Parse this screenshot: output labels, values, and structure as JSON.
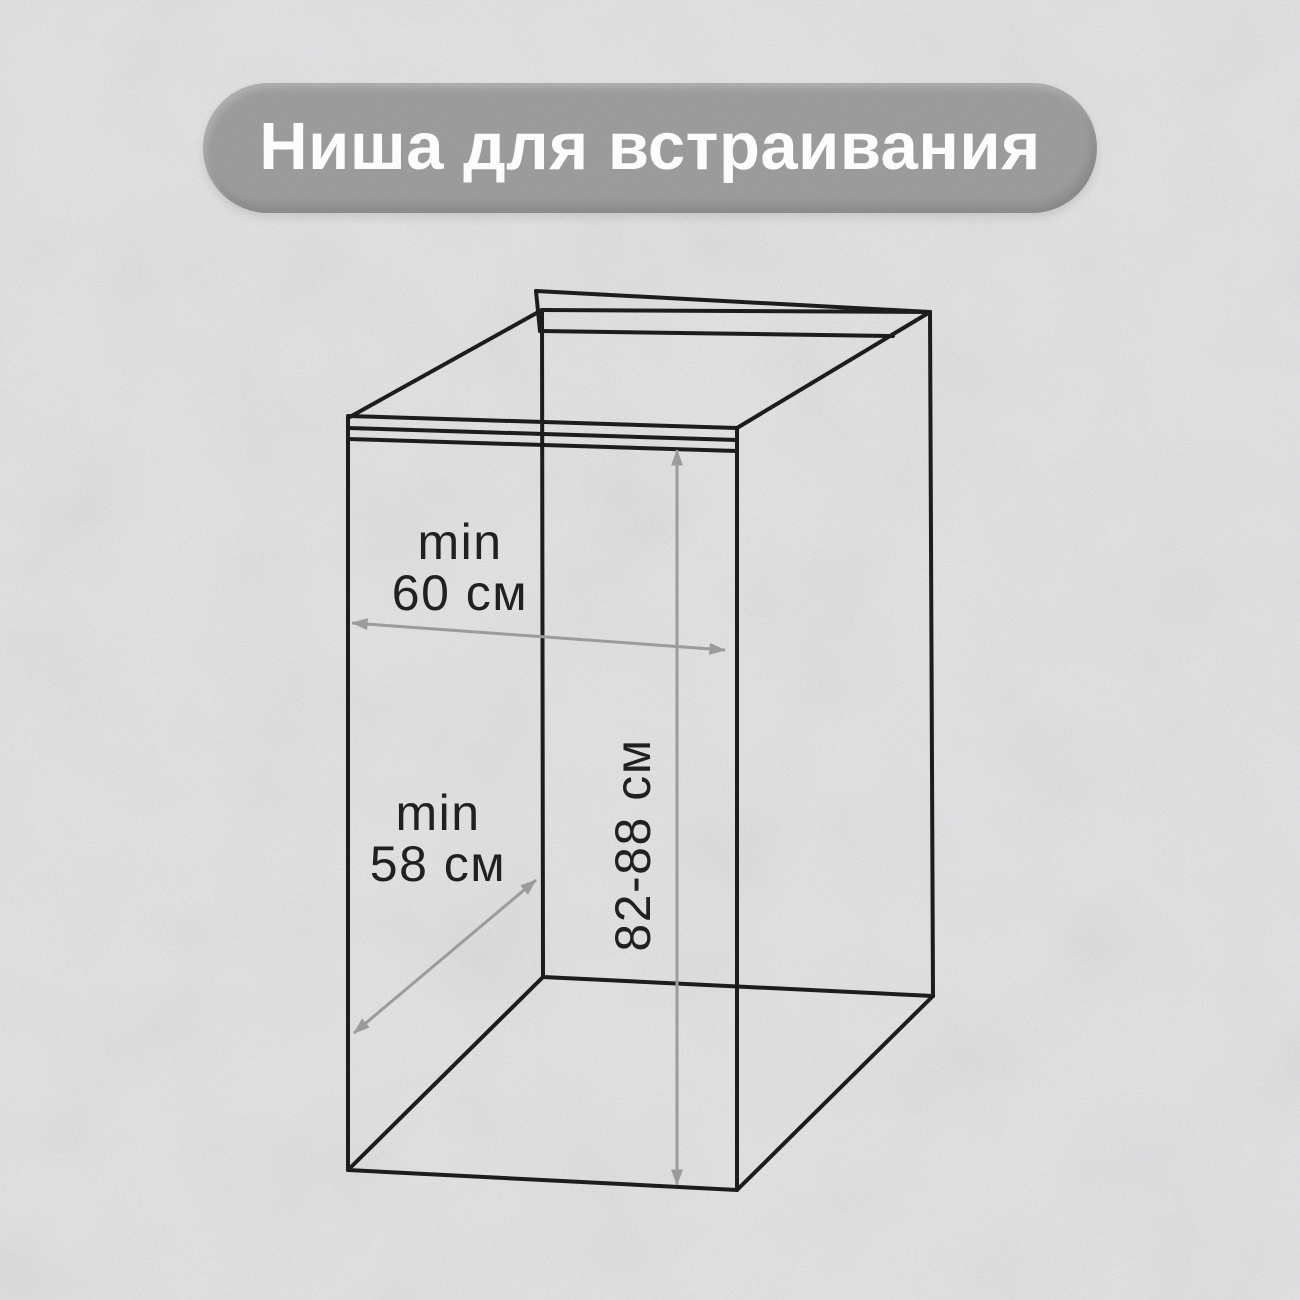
{
  "title": "Ниша для встраивания",
  "labels": {
    "width": {
      "prefix": "min",
      "value": "60 см"
    },
    "depth": {
      "prefix": "min",
      "value": "58 см"
    },
    "height": {
      "value": "82-88 см"
    }
  },
  "colors": {
    "background": "#e3e3e5",
    "wireframe_line": "#171717",
    "dimension_line": "#9a9a9a",
    "pill_background": "#9a9a9b",
    "title_text": "#ffffff",
    "label_text": "#1b1b1b"
  }
}
